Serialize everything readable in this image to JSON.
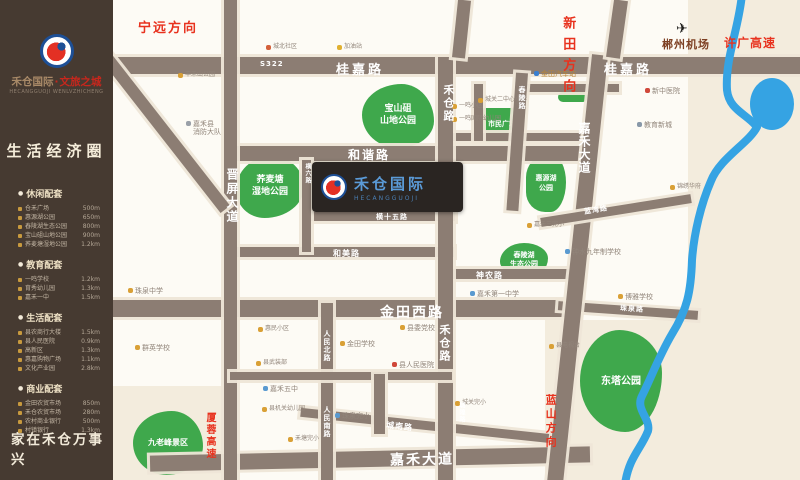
{
  "sidebar": {
    "logo": {
      "brand": "禾仓国际",
      "sep": "·",
      "sub": "文旅之城",
      "pinyin": "HECANGGUOJI  WENLVZHICHENG"
    },
    "headline": "生活经济圈",
    "slogan": "家在禾仓万事兴",
    "sections": [
      {
        "title": "休闲配套",
        "items": [
          {
            "name": "仓禾广场",
            "dist": "500m"
          },
          {
            "name": "惠源湖公园",
            "dist": "650m"
          },
          {
            "name": "舂陵湖生态公园",
            "dist": "800m"
          },
          {
            "name": "宝山砠山地公园",
            "dist": "900m"
          },
          {
            "name": "荞麦塘湿地公园",
            "dist": "1.2km"
          }
        ]
      },
      {
        "title": "教育配套",
        "items": [
          {
            "name": "一鸣学校",
            "dist": "1.2km"
          },
          {
            "name": "育秀幼儿园",
            "dist": "1.3km"
          },
          {
            "name": "嘉禾一中",
            "dist": "1.5km"
          }
        ]
      },
      {
        "title": "生活配套",
        "items": [
          {
            "name": "县农商行大楼",
            "dist": "1.5km"
          },
          {
            "name": "县人民医院",
            "dist": "0.9km"
          },
          {
            "name": "高新区",
            "dist": "1.3km"
          },
          {
            "name": "惠嘉购物广场",
            "dist": "1.1km"
          },
          {
            "name": "文化产业园",
            "dist": "2.8km"
          }
        ]
      },
      {
        "title": "商业配套",
        "items": [
          {
            "name": "金田农贸市场",
            "dist": "850m"
          },
          {
            "name": "禾仓农贸市场",
            "dist": "280m"
          },
          {
            "name": "农村商业银行",
            "dist": "500m"
          },
          {
            "name": "村镇银行",
            "dist": "1.3km"
          }
        ]
      }
    ]
  },
  "map": {
    "project": {
      "name": "禾仓国际",
      "pinyin": "HECANGGUOJI"
    },
    "road_labels": [
      {
        "text": "桂嘉路",
        "x": 336,
        "y": 59,
        "fs": 13,
        "ls": 3
      },
      {
        "text": "桂嘉路",
        "x": 604,
        "y": 59,
        "fs": 13,
        "ls": 3
      },
      {
        "text": "S322",
        "x": 260,
        "y": 60,
        "fs": 7,
        "ls": 1
      },
      {
        "text": "和谐路",
        "x": 348,
        "y": 146,
        "fs": 12,
        "ls": 2
      },
      {
        "text": "横十五路",
        "x": 376,
        "y": 212,
        "fs": 7
      },
      {
        "text": "和美路",
        "x": 333,
        "y": 248,
        "fs": 8,
        "ls": 1
      },
      {
        "text": "神农路",
        "x": 476,
        "y": 270,
        "fs": 8,
        "ls": 1
      },
      {
        "text": "金田西路",
        "x": 380,
        "y": 302,
        "fs": 14,
        "ls": 2
      },
      {
        "text": "珠泉路",
        "x": 620,
        "y": 304,
        "fs": 7,
        "rot": 4
      },
      {
        "text": "嘉禾大道",
        "x": 390,
        "y": 449,
        "fs": 14,
        "ls": 2,
        "rot": -1
      },
      {
        "text": "城南路",
        "x": 386,
        "y": 421,
        "fs": 8,
        "rot": 6
      },
      {
        "text": "晋屏大道",
        "x": 224,
        "y": 168,
        "fs": 12,
        "v": true,
        "ls": 2
      },
      {
        "text": "横六路",
        "x": 303,
        "y": 163,
        "fs": 6,
        "v": true
      },
      {
        "text": "人民北路",
        "x": 322,
        "y": 330,
        "fs": 7,
        "v": true
      },
      {
        "text": "人民南路",
        "x": 322,
        "y": 406,
        "fs": 7,
        "v": true
      },
      {
        "text": "禾仓路",
        "x": 440,
        "y": 84,
        "fs": 11,
        "v": true,
        "ls": 2
      },
      {
        "text": "禾仓路",
        "x": 436,
        "y": 324,
        "fs": 11,
        "v": true,
        "ls": 2
      },
      {
        "text": "嘉禾大道",
        "x": 576,
        "y": 122,
        "fs": 12,
        "v": true,
        "ls": 1
      },
      {
        "text": "舂陵路",
        "x": 517,
        "y": 86,
        "fs": 7,
        "v": true
      },
      {
        "text": "蓝湾路",
        "x": 584,
        "y": 205,
        "fs": 7,
        "rot": -9
      },
      {
        "text": "城隍路",
        "x": 457,
        "y": 402,
        "fs": 6,
        "v": true
      }
    ],
    "directions": [
      {
        "text": "宁远方向",
        "x": 138,
        "y": 22,
        "fs": 13,
        "ls": 2
      },
      {
        "text": "新田方向",
        "x": 560,
        "y": 16,
        "fs": 13,
        "v": true,
        "ls": 8
      },
      {
        "text": "许广高速",
        "x": 724,
        "y": 37,
        "fs": 12,
        "ls": 1
      },
      {
        "text": "郴州机场",
        "x": 662,
        "y": 39,
        "fs": 11,
        "ls": 1,
        "color": "#7d3f22",
        "icon": "plane"
      },
      {
        "text": "蓝山方向",
        "x": 544,
        "y": 394,
        "fs": 11,
        "v": true,
        "ls": 3
      },
      {
        "text": "厦蓉高速",
        "x": 204,
        "y": 412,
        "fs": 10,
        "v": true,
        "ls": 2
      }
    ],
    "parks": [
      {
        "lines": [
          "荞麦塘",
          "湿地公园"
        ],
        "x": 236,
        "y": 156,
        "w": 68,
        "h": 62,
        "fs": 9,
        "r": "52% 48% 58% 42% / 55% 50% 50% 45%"
      },
      {
        "lines": [
          "宝山砠",
          "山地公园"
        ],
        "x": 362,
        "y": 84,
        "w": 72,
        "h": 64,
        "fs": 9,
        "r": "55% 45% 50% 50% / 48% 58% 42% 52%"
      },
      {
        "lines": [
          "市民广场"
        ],
        "x": 481,
        "y": 108,
        "w": 42,
        "h": 34,
        "fs": 7,
        "r": "4px"
      },
      {
        "lines": [
          "惠源湖",
          "公园"
        ],
        "x": 526,
        "y": 155,
        "w": 40,
        "h": 57,
        "fs": 7,
        "r": "60% 40% 45% 55% / 45% 55% 60% 40%"
      },
      {
        "lines": [
          "舂陵湖",
          "生态公园"
        ],
        "x": 500,
        "y": 243,
        "w": 48,
        "h": 34,
        "fs": 7,
        "r": "50% 50% 40% 60% / 55% 45% 55% 45%"
      },
      {
        "lines": [
          "东塔公园"
        ],
        "x": 580,
        "y": 330,
        "w": 82,
        "h": 102,
        "fs": 10,
        "r": "48% 52% 45% 55% / 50% 42% 58% 50%"
      },
      {
        "lines": [
          "九老峰景区"
        ],
        "x": 133,
        "y": 411,
        "w": 70,
        "h": 64,
        "fs": 8,
        "r": "55% 45% 52% 48% / 50% 55% 45% 50%"
      },
      {
        "lines": [],
        "x": 558,
        "y": 92,
        "w": 30,
        "h": 10,
        "fs": 5,
        "r": "5px"
      }
    ],
    "pois": [
      {
        "lines": [
          "嘉禾县",
          "消防大队"
        ],
        "x": 186,
        "y": 120,
        "fs": 7,
        "dot": "#9aa0a8"
      },
      {
        "lines": [
          "丰禾山公园"
        ],
        "x": 178,
        "y": 72,
        "fs": 6,
        "dot": "#d9a036"
      },
      {
        "lines": [
          "城北社区"
        ],
        "x": 266,
        "y": 44,
        "fs": 6,
        "dot": "#d4603a"
      },
      {
        "lines": [
          "加油站"
        ],
        "x": 337,
        "y": 44,
        "fs": 6,
        "dot": "#e0b030"
      },
      {
        "lines": [
          "金田汽车站"
        ],
        "x": 534,
        "y": 70,
        "fs": 7,
        "dot": "#3a7fd0",
        "color": "#b98434"
      },
      {
        "lines": [
          "新中医院"
        ],
        "x": 645,
        "y": 87,
        "fs": 7,
        "dot": "#d0483a"
      },
      {
        "lines": [
          "教育新城"
        ],
        "x": 637,
        "y": 121,
        "fs": 7,
        "dot": "#8898a8"
      },
      {
        "lines": [
          "一鸣小区"
        ],
        "x": 452,
        "y": 103,
        "fs": 6,
        "dot": "#d9a036"
      },
      {
        "lines": [
          "一鸣国际幼儿园"
        ],
        "x": 452,
        "y": 116,
        "fs": 6,
        "dot": "#d9a036"
      },
      {
        "lines": [
          "城关二中心小学"
        ],
        "x": 478,
        "y": 97,
        "fs": 6,
        "dot": "#d9a036"
      },
      {
        "lines": [
          "嘉禾三完小"
        ],
        "x": 527,
        "y": 222,
        "fs": 6,
        "dot": "#d9a036"
      },
      {
        "lines": [
          "锦绣华府"
        ],
        "x": 670,
        "y": 184,
        "fs": 6,
        "dot": "#d9a036"
      },
      {
        "lines": [
          "钟水九年制学校"
        ],
        "x": 565,
        "y": 248,
        "fs": 7,
        "dot": "#5a9ad0"
      },
      {
        "lines": [
          "博雅学校"
        ],
        "x": 618,
        "y": 293,
        "fs": 7,
        "dot": "#d9a036"
      },
      {
        "lines": [
          "嘉禾第一中学"
        ],
        "x": 470,
        "y": 290,
        "fs": 7,
        "dot": "#5a9ad0"
      },
      {
        "lines": [
          "县委党校"
        ],
        "x": 400,
        "y": 324,
        "fs": 7,
        "dot": "#d9a036"
      },
      {
        "lines": [
          "金田学校"
        ],
        "x": 340,
        "y": 340,
        "fs": 7,
        "dot": "#d9a036"
      },
      {
        "lines": [
          "县人民医院"
        ],
        "x": 392,
        "y": 361,
        "fs": 7,
        "dot": "#d0483a"
      },
      {
        "lines": [
          "珠泉中学"
        ],
        "x": 128,
        "y": 287,
        "fs": 7,
        "dot": "#d9a036"
      },
      {
        "lines": [
          "群英学校"
        ],
        "x": 135,
        "y": 344,
        "fs": 7,
        "dot": "#d9a036"
      },
      {
        "lines": [
          "惠民小区"
        ],
        "x": 258,
        "y": 326,
        "fs": 6,
        "dot": "#d9a036"
      },
      {
        "lines": [
          "县武装部"
        ],
        "x": 256,
        "y": 360,
        "fs": 6,
        "dot": "#d9a036"
      },
      {
        "lines": [
          "嘉禾五中"
        ],
        "x": 263,
        "y": 385,
        "fs": 7,
        "dot": "#5a9ad0"
      },
      {
        "lines": [
          "珠泉完小"
        ],
        "x": 335,
        "y": 412,
        "fs": 7,
        "dot": "#5a9ad0"
      },
      {
        "lines": [
          "城关完小"
        ],
        "x": 455,
        "y": 400,
        "fs": 6,
        "dot": "#d9a036"
      },
      {
        "lines": [
          "县电视台"
        ],
        "x": 549,
        "y": 343,
        "fs": 6,
        "dot": "#d9a036"
      },
      {
        "lines": [
          "县机关幼儿园"
        ],
        "x": 262,
        "y": 406,
        "fs": 6,
        "dot": "#d9a036"
      },
      {
        "lines": [
          "禾塘完小"
        ],
        "x": 288,
        "y": 436,
        "fs": 6,
        "dot": "#d9a036"
      }
    ]
  },
  "colors": {
    "brand_blue": "#1d4f96",
    "brand_red": "#e33024",
    "park_green": "#3fa84c",
    "river_blue": "#35a3e3",
    "road_taupe": "#8c7d73",
    "sidebar_brown": "#463a31",
    "direction_red": "#e8321e"
  }
}
